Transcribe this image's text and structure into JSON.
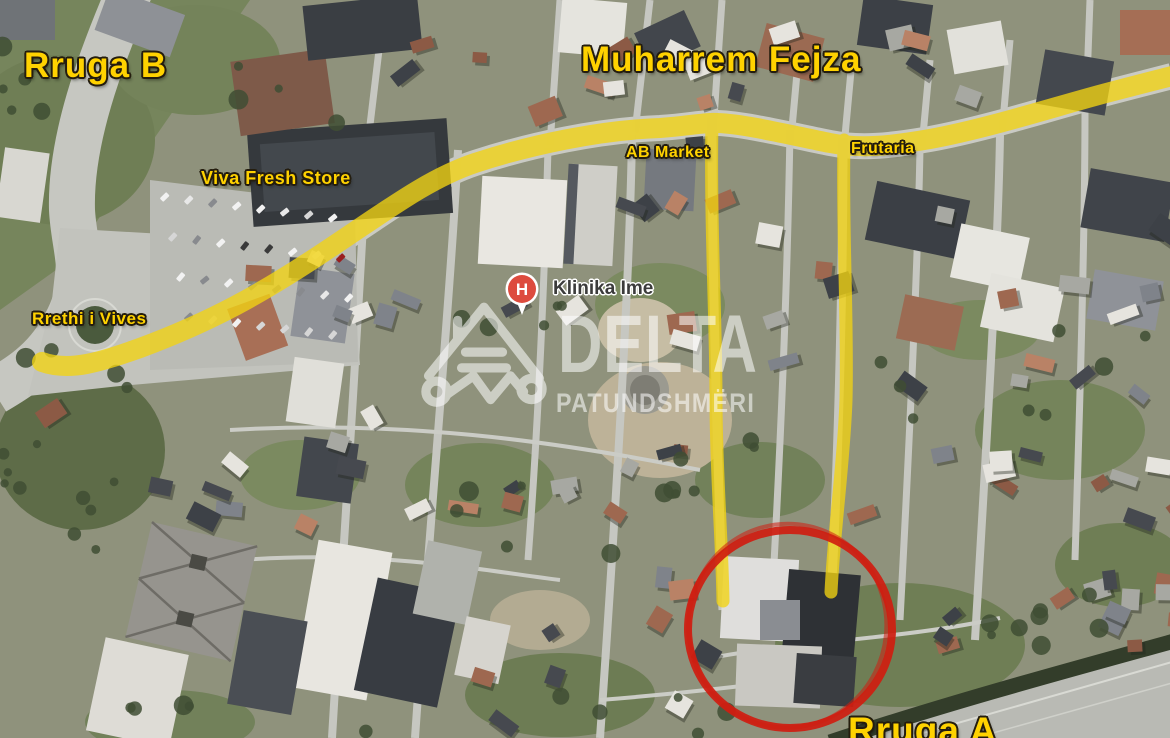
{
  "map": {
    "type": "annotated-satellite-map",
    "labels": {
      "rruga_b": "Rruga B",
      "muharrem_fejza": "Muharrem Fejza",
      "viva_fresh_store": "Viva Fresh Store",
      "ab_market": "AB Market",
      "frutaria": "Frutaria",
      "rrethi_i_vives": "Rrethi i Vives",
      "klinika_ime": "Klinika Ime",
      "rruga_a": "Rruga A"
    },
    "markers": {
      "hospital_letter": "H"
    },
    "watermark": {
      "line1": "DELTA",
      "line2": "PATUNDSHMËRI"
    },
    "colors": {
      "highlight_yellow": "#f2d312",
      "label_yellow": "#ffd200",
      "circle_red": "#cf1d10",
      "hospital_red": "#dd4b3e",
      "label_dark": "#3b3b3b",
      "watermark_white": "#ffffff"
    }
  }
}
